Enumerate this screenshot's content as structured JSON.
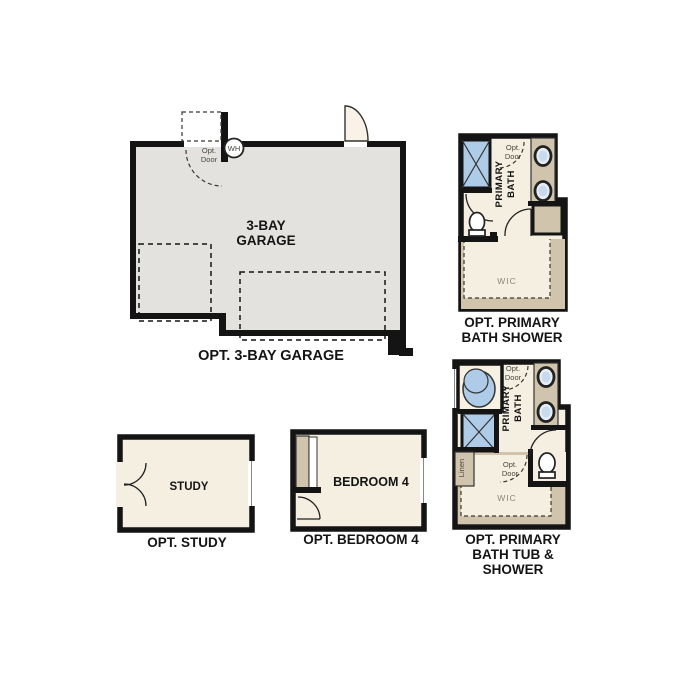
{
  "colors": {
    "wall": "#141414",
    "garage_floor": "#e3e2df",
    "room_floor": "#f5efe1",
    "cabinet_tan": "#d0c4ac",
    "fixture_blue": "#aecbe8",
    "door_wedge": "#faf2e7",
    "small_label": "#4a463f",
    "wic_label": "#8a867c"
  },
  "plans": {
    "garage": {
      "room_label_line1": "3-BAY",
      "room_label_line2": "GARAGE",
      "caption": "OPT. 3-BAY GARAGE",
      "water_heater_label": "WH",
      "opt_door_label_line1": "Opt.",
      "opt_door_label_line2": "Door"
    },
    "primary_bath_shower": {
      "room_label_line1": "PRIMARY",
      "room_label_line2": "BATH",
      "opt_door_label_line1": "Opt.",
      "opt_door_label_line2": "Door",
      "closet_label": "WIC",
      "caption_line1": "OPT. PRIMARY",
      "caption_line2": "BATH SHOWER"
    },
    "primary_bath_tub_shower": {
      "room_label_line1": "PRIMARY",
      "room_label_line2": "BATH",
      "opt_door_top_label_line1": "Opt.",
      "opt_door_top_label_line2": "Door",
      "opt_door_wic_label_line1": "Opt.",
      "opt_door_wic_label_line2": "Door",
      "linen_label": "Linen",
      "closet_label": "WIC",
      "caption_line1": "OPT. PRIMARY",
      "caption_line2": "BATH TUB &",
      "caption_line3": "SHOWER"
    },
    "study": {
      "room_label": "STUDY",
      "caption": "OPT. STUDY"
    },
    "bedroom4": {
      "room_label": "BEDROOM 4",
      "caption": "OPT. BEDROOM 4"
    }
  }
}
